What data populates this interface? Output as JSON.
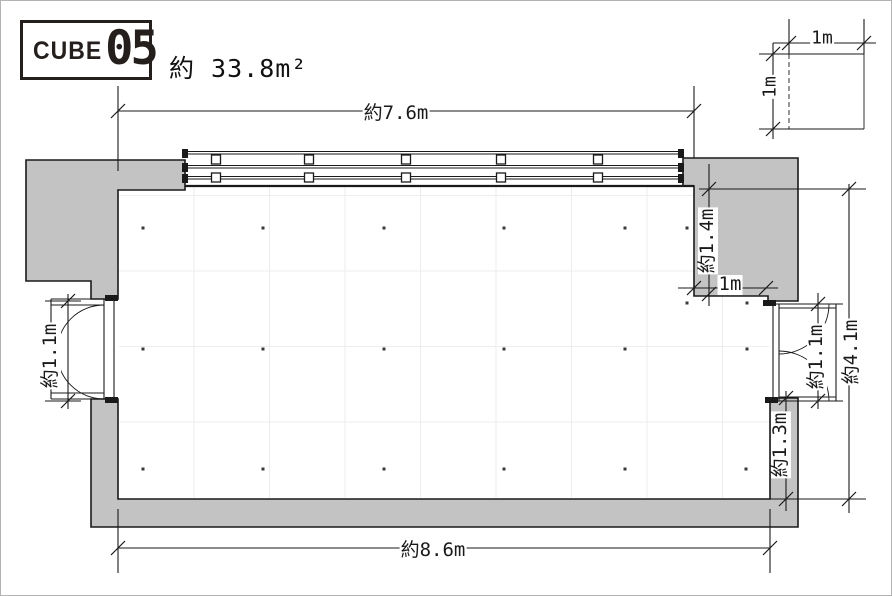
{
  "title": {
    "brand": "CUBE",
    "number": "05",
    "area": "約 33.8m²"
  },
  "dimensions": {
    "top_width": "約7.6m",
    "bottom_width": "約8.6m",
    "right_overall_height": "約4.1m",
    "right_upper_wall": "約1.4m",
    "right_step": "1m",
    "right_door": "約1.1m",
    "right_lower_wall": "約1.3m",
    "left_door": "約1.1m",
    "scale_square_top": "1m",
    "scale_square_left": "1m"
  },
  "colors": {
    "wall": "#c3c3c3",
    "line": "#1a1a1a",
    "grid": "#ededed",
    "dot": "#3a3a3a",
    "label_bg": "#ffffff",
    "logo": "#241f1c"
  }
}
